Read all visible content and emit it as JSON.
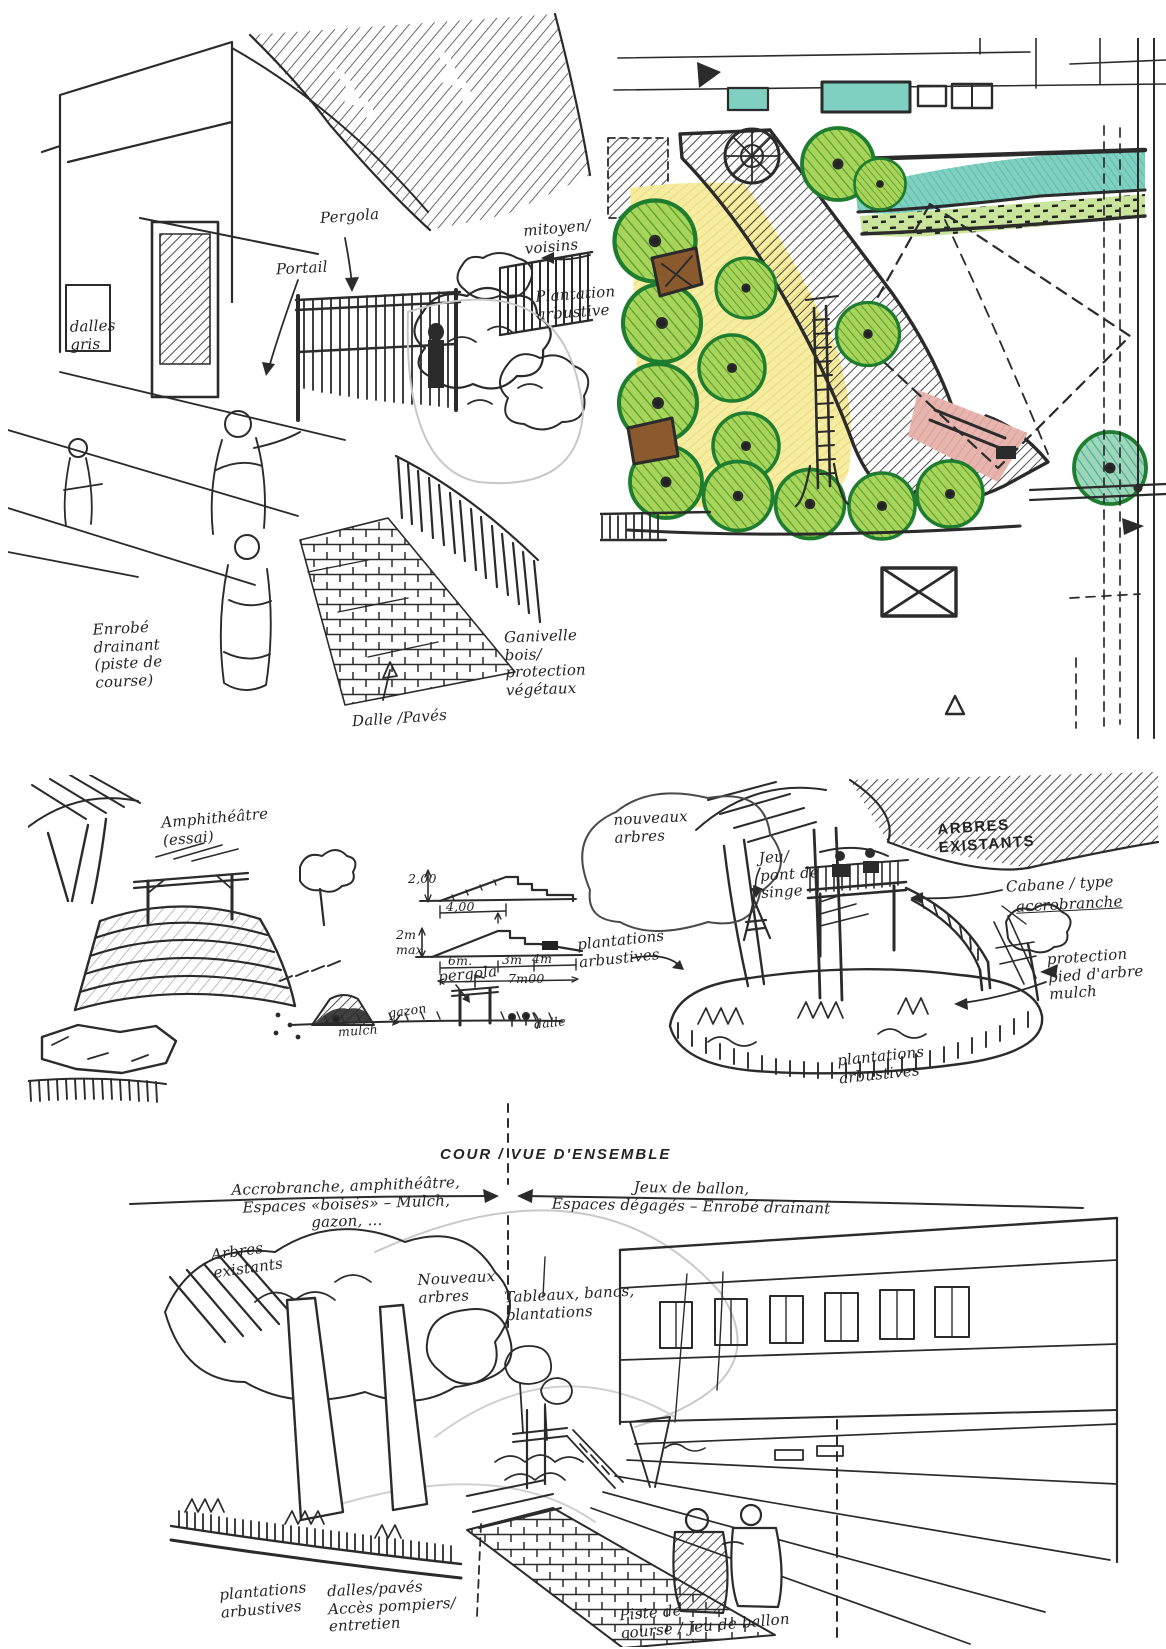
{
  "palette": {
    "ink": "#2b2b2b",
    "paper": "#ffffff",
    "tree_green": "#a9d45c",
    "tree_outline": "#1f7d2f",
    "leaf_hatch": "#58a22e",
    "yellow": "#f6eda2",
    "teal": "#7fd0c0",
    "pink": "#e7b5ae",
    "brown": "#8a5a2e",
    "pencil": "#c9c9c9"
  },
  "entrance_sketch": {
    "labels": {
      "pergola": "Pergola",
      "portail": "Portail",
      "mitoyen": "mitoyen/\nvoisins",
      "plantation": "Plantation\narbustive",
      "dalles_gris": "dalles\ngris",
      "enrobe": "Enrobé\ndrainant\n(piste de\ncourse)",
      "ganivelle": "Ganivelle\nbois/\nprotection\nvégétaux",
      "dalle_paves": "Dalle /Pavés"
    }
  },
  "amphitheatre_sketch": {
    "labels": {
      "title": "Amphithéâtre\n(essai)",
      "dim_h1": "2,00",
      "dim_w1": "4,00",
      "dim_h2": "2m\nmax",
      "dim_6m": "6m.",
      "dim_3m": "3m",
      "dim_4m": "4m",
      "dim_total": "7m00",
      "mulch": "mulch",
      "gazon": "gazon",
      "pergola": "pergola",
      "dalle": "dalle"
    }
  },
  "treehouse_sketch": {
    "labels": {
      "nouveaux_arbres": "nouveaux\narbres",
      "jeu_pont_de_singe": "Jeu/\npont de\nsinge",
      "arbres_existants": "ARBRES\nEXISTANTS",
      "cabane_1": "Cabane / type",
      "cabane_2": "accrobranche",
      "protection": "protection\npied d'arbre\nmulch",
      "plantations_gauche": "plantations\narbustives",
      "plantations_bas": "plantations\narbustives"
    }
  },
  "overview_sketch": {
    "labels": {
      "title": "COUR / VUE D'ENSEMBLE",
      "zone_gauche": "Accrobranche, amphithéâtre,\nEspaces «boisés» – Mulch,\ngazon, …",
      "zone_droite": "Jeux de ballon,\nEspaces dégagés – Enrobé drainant",
      "arbres_existants": "Arbres\nexistants",
      "nouveaux_arbres": "Nouveaux\narbres",
      "tableaux": "Tableaux, bancs,\nplantations",
      "plantations": "plantations\narbustives",
      "acces": "dalles/pavés\nAccès pompiers/\nentretien",
      "piste": "Piste de\ncourse / Jeu de ballon"
    }
  }
}
